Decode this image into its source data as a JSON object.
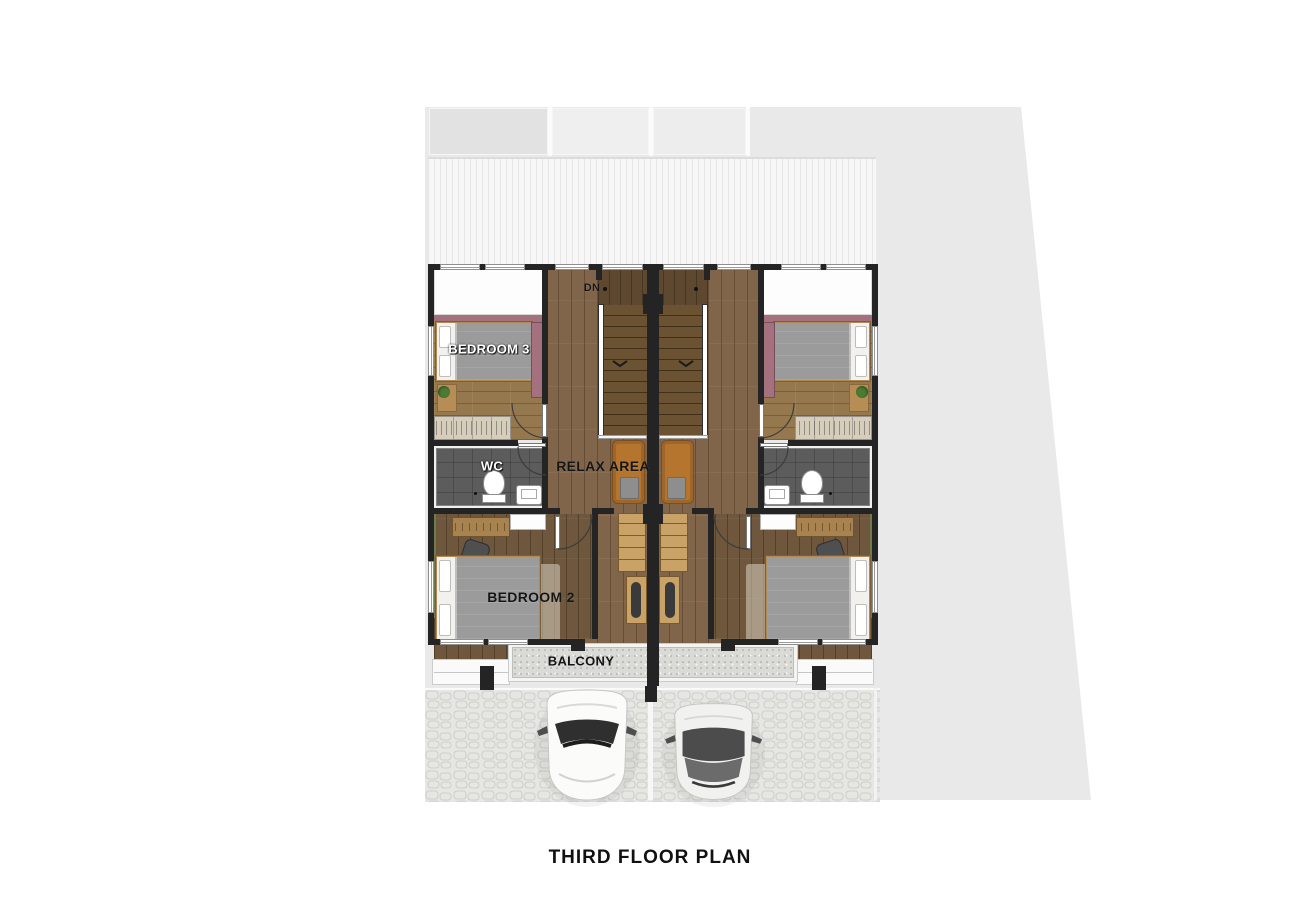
{
  "title": "THIRD FLOOR PLAN",
  "labels": {
    "bedroom3": "BEDROOM 3",
    "bedroom2": "BEDROOM 2",
    "wc": "WC",
    "relax_area": "RELAX AREA",
    "balcony": "BALCONY",
    "stairs_down": "DN"
  },
  "colors": {
    "wall": "#242424",
    "site": "#e9e9e9",
    "roof": "#f7f7f7",
    "stone": "#e6e6e3",
    "concrete": "#dadad6",
    "wood-hall": "#80654a",
    "wood-bed3": "#96784e",
    "wood-bed2": "#6e573c",
    "wood-stair": "#5e4830",
    "pink": "#a6717e",
    "green": "#6f7b4d",
    "wc-floor": "#5c5c5c",
    "wardrobe": "#d6cebb",
    "chair-tan": "#b5752f",
    "shelf-wood": "#c8a266",
    "bed-blanket": "#9b9b9b",
    "car-white": "#fbfbfa",
    "car-gray": "#f1f1f0"
  }
}
